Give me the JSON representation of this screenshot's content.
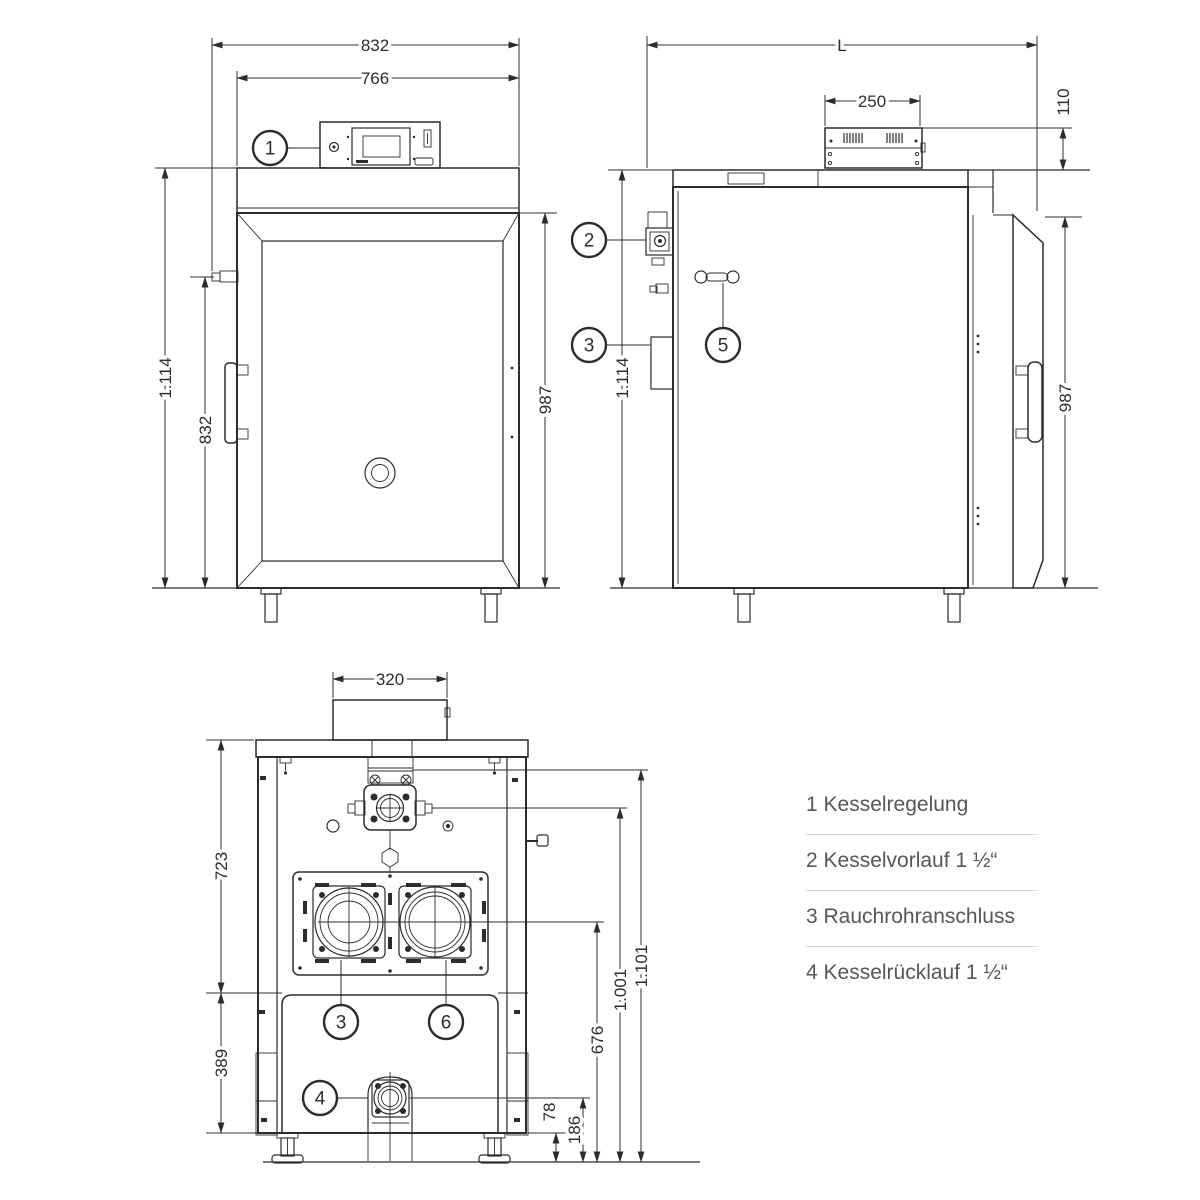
{
  "drawing": {
    "front": {
      "dim_total_width": "832",
      "dim_door_width": "766",
      "dim_total_height": "1.114",
      "dim_fitting_height": "832",
      "dim_body_height": "987",
      "callout_controller": "1"
    },
    "side": {
      "dim_length": "L",
      "dim_box_width": "250",
      "dim_box_height": "110",
      "dim_total_height": "1.114",
      "dim_body_height": "987",
      "callout_flow": "2",
      "callout_flue": "3",
      "callout_door_handle": "5"
    },
    "rear": {
      "dim_duct_width": "320",
      "dim_upper_height": "723",
      "dim_lower_height": "389",
      "dim_flue_center_height": "676",
      "dim_flow_center_height": "1.001",
      "dim_top_edge_height": "1.101",
      "dim_return_offset": "78",
      "dim_return_center_height": "186",
      "callout_flue": "3",
      "callout_port_six": "6",
      "callout_return": "4"
    }
  },
  "legend": {
    "items": [
      {
        "text": "1 Kesselregelung"
      },
      {
        "text": "2 Kesselvorlauf 1 ½“"
      },
      {
        "text": "3 Rauchrohranschluss"
      },
      {
        "text": "4 Kesselrücklauf 1 ½“"
      }
    ]
  },
  "colors": {
    "line": "#2c2c2e",
    "legend_text": "#54575c",
    "divider": "#d9d9d9",
    "background": "#ffffff"
  }
}
